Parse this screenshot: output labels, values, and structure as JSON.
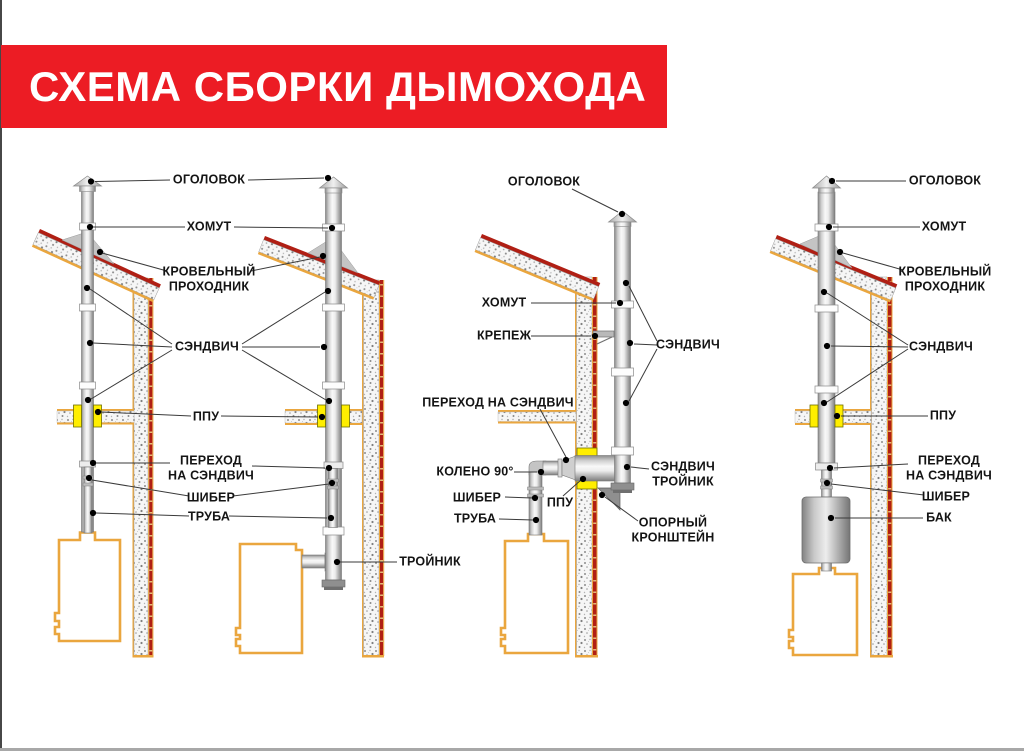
{
  "title": "СХЕМА СБОРКИ ДЫМОХОДА",
  "colors": {
    "banner_red": "#ec1c24",
    "roof_red": "#b01f14",
    "outline_orange": "#eaa63e",
    "insulation_yellow": "#ffee00",
    "pipe_gray": "#c9c9c9"
  },
  "labels": {
    "col12": {
      "ogolovok": "ОГОЛОВОК",
      "khomut": "ХОМУТ",
      "krovelny_prohodnik": "КРОВЕЛЬНЫЙ\nПРОХОДНИК",
      "sandwich": "СЭНДВИЧ",
      "ppu": "ППУ",
      "perekhod_na_sandwich": "ПЕРЕХОД\nНА СЭНДВИЧ",
      "shiber": "ШИБЕР",
      "truba": "ТРУБА",
      "troynik": "ТРОЙНИК"
    },
    "d3": {
      "ogolovok": "ОГОЛОВОК",
      "khomut": "ХОМУТ",
      "krepezh": "КРЕПЕЖ",
      "sandwich": "СЭНДВИЧ",
      "perekhod_na_sandwich": "ПЕРЕХОД НА СЭНДВИЧ",
      "koleno90": "КОЛЕНО 90°",
      "shiber": "ШИБЕР",
      "truba": "ТРУБА",
      "ppu": "ППУ",
      "sandwich_troynik": "СЭНДВИЧ\nТРОЙНИК",
      "oporny_kronshteyn": "ОПОРНЫЙ\nКРОНШТЕЙН"
    },
    "d4": {
      "ogolovok": "ОГОЛОВОК",
      "khomut": "ХОМУТ",
      "krovelny_prohodnik": "КРОВЕЛЬНЫЙ\nПРОХОДНИК",
      "sandwich": "СЭНДВИЧ",
      "ppu": "ППУ",
      "perekhod_na_sandwich": "ПЕРЕХОД\nНА СЭНДВИЧ",
      "shiber": "ШИБЕР",
      "bak": "БАК"
    }
  }
}
